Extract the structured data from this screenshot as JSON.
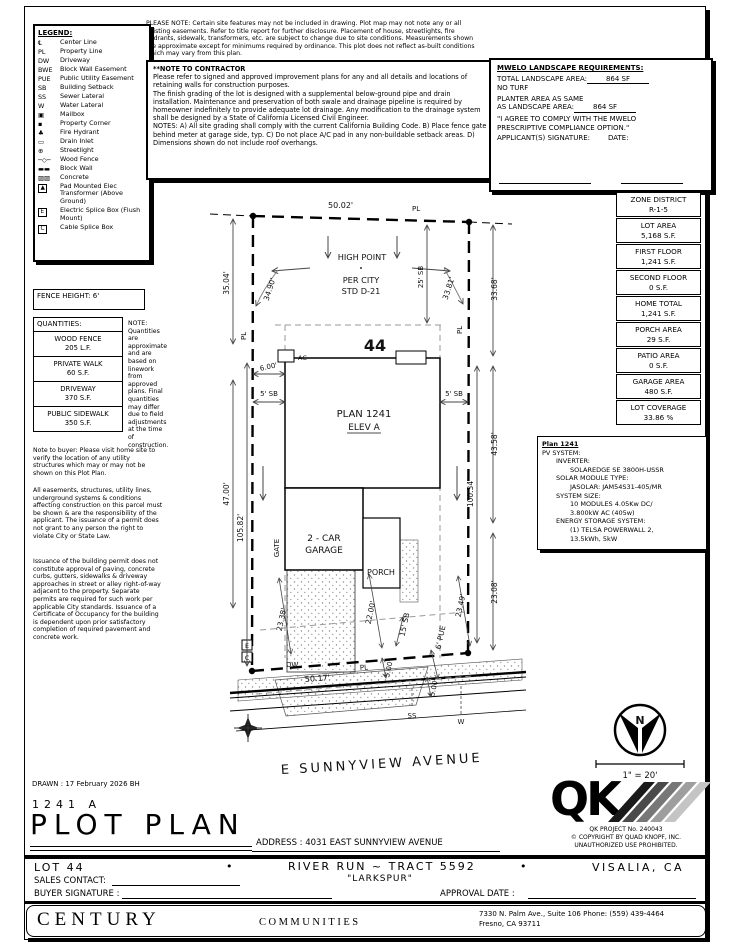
{
  "please_note": "PLEASE NOTE:  Certain site features may not be included in drawing.  Plot map may not note any or all existing easements.  Refer to title report for further disclosure.  Placement of house, streetlights, fire hydrants, sidewalk, transformers, etc. are subject to change due to site conditions.  Measurements shown are approximate except for minimums required by ordinance.  This plot does not reflect as-built conditions which may vary from this plan.",
  "legend": {
    "title": "LEGEND:",
    "items": [
      {
        "sym": "℄",
        "label": "Center Line"
      },
      {
        "sym": "PL",
        "label": "Property Line"
      },
      {
        "sym": "DW",
        "label": "Driveway"
      },
      {
        "sym": "BWE",
        "label": "Block Wall Easement"
      },
      {
        "sym": "PUE",
        "label": "Public Utility Easement"
      },
      {
        "sym": "SB",
        "label": "Building Setback"
      },
      {
        "sym": "SS",
        "label": "Sewer Lateral"
      },
      {
        "sym": "W",
        "label": "Water Lateral"
      },
      {
        "sym": "▣",
        "label": "Mailbox"
      },
      {
        "sym": "▪",
        "label": "Property Corner"
      },
      {
        "sym": "♣",
        "label": "Fire Hydrant"
      },
      {
        "sym": "▭",
        "label": "Drain Inlet"
      },
      {
        "sym": "⊕",
        "label": "Streetlight"
      },
      {
        "sym": "─◇─",
        "label": "Wood Fence"
      },
      {
        "sym": "▬▬",
        "label": "Block Wall"
      },
      {
        "sym": "▨▨",
        "label": "Concrete"
      },
      {
        "sym": "▲",
        "label": "Pad Mounted Elec Transformer (Above Ground)"
      },
      {
        "sym": "E",
        "label": "Electric Splice Box (Flush Mount)"
      },
      {
        "sym": "C",
        "label": "Cable Splice Box"
      }
    ]
  },
  "contractor_note": {
    "title": "**NOTE TO CONTRACTOR",
    "p1": "Please refer to signed and approved improvement plans for any and all details and locations of retaining walls for construction purposes.",
    "p2": "The finish grading of the lot is designed with a supplemental below-ground pipe and drain installation.  Maintenance and preservation of both swale and drainage pipeline is required by homeowner indefinitely to provide adequate lot drainage.  Any modification to the drainage system shall be designed by a State of California Licensed Civil Engineer.",
    "p3": "NOTES:  A) All site grading shall comply with the current California Building Code.  B) Place fence gate behind meter at garage side, typ.  C) Do not place A/C pad in any non-buildable setback areas.  D) Dimensions shown do not include roof overhangs."
  },
  "mwelo": {
    "title": "MWELO LANDSCAPE REQUIREMENTS:",
    "row1_label": "TOTAL LANDSCAPE AREA:",
    "row1_value": "864 SF",
    "row2": "NO TURF",
    "row3a": "PLANTER AREA AS SAME",
    "row3b": "AS LANDSCAPE AREA:",
    "row3_value": "864 SF",
    "agree": "\"I AGREE TO COMPLY WITH THE MWELO PRESCRIPTIVE COMPLIANCE OPTION.\"",
    "sig_label": "APPLICANT(S) SIGNATURE:",
    "date_label": "DATE:"
  },
  "fence_height": "FENCE HEIGHT: 6'",
  "quantities": {
    "title": "QUANTITIES:",
    "rows": [
      {
        "name": "WOOD FENCE",
        "value": "205 L.F."
      },
      {
        "name": "PRIVATE WALK",
        "value": "60 S.F."
      },
      {
        "name": "DRIVEWAY",
        "value": "370 S.F."
      },
      {
        "name": "PUBLIC SIDEWALK",
        "value": "350 S.F."
      }
    ],
    "note": "NOTE: Quantities are approximate and are based on linework from approved plans.  Final quantities may differ due to field adjustments at the time of construction."
  },
  "notes": {
    "buyer": "Note to buyer: Please visit home site to verify the location of any utility structures which may or may not be shown on this Plot Plan.",
    "easements": "All easements, structures, utility lines, underground systems & conditions affecting construction on this parcel must be shown & are the responsibility of the applicant.  The issuance of a permit does not grant to any person the right to violate City or State Law.",
    "permit": "Issuance of the building permit does not constitute approval of paving, concrete curbs, gutters, sidewalks & driveway approaches in street or alley right-of-way adjacent to the property.  Separate permits are required for such work per applicable City standards.  Issuance of a Certificate of Occupancy for the building is dependent upon prior satisfactory completion of required pavement and concrete work."
  },
  "zone_table": [
    {
      "label": "ZONE DISTRICT",
      "value": "R-1-5"
    },
    {
      "label": "LOT AREA",
      "value": "5,168 S.F."
    },
    {
      "label": "FIRST FLOOR",
      "value": "1,241 S.F."
    },
    {
      "label": "SECOND FLOOR",
      "value": "0 S.F."
    },
    {
      "label": "HOME TOTAL",
      "value": "1,241 S.F."
    },
    {
      "label": "PORCH AREA",
      "value": "29 S.F."
    },
    {
      "label": "PATIO AREA",
      "value": "0 S.F."
    },
    {
      "label": "GARAGE AREA",
      "value": "480 S.F."
    },
    {
      "label": "LOT COVERAGE",
      "value": "33.86 %"
    }
  ],
  "pv": {
    "title": "Plan 1241",
    "l1": "PV SYSTEM:",
    "l2": "INVERTER:",
    "l3": "SOLAREDGE SE 3800H-USSR",
    "l4": "SOLAR MODULE TYPE:",
    "l5": "JASOLAR: JAM54S31-405/MR",
    "l6": "SYSTEM SIZE:",
    "l7": "10 MODULES 4.05Kw DC/",
    "l8": "3.800kW AC (405w)",
    "l9": "ENERGY STORAGE SYSTEM:",
    "l10": "(1) TELSA POWERWALL 2,",
    "l11": "13.5kWh, 5kW"
  },
  "site": {
    "d50_02": "50.02'",
    "pl": "PL",
    "high1": "HIGH POINT",
    "high2": "PER CITY",
    "high3": "STD D-21",
    "sb25": "25' SB",
    "lot_no": "44",
    "ac": "AC",
    "d35_04": "35.04'",
    "d34_90": "34.90'",
    "d33_81": "33.81'",
    "d33_68": "33.68'",
    "d6_00": "6.00'",
    "sb5": "5' SB",
    "plan1": "PLAN 1241",
    "plan2": "ELEV A",
    "d47_00": "47.00'",
    "d105_82": "105.82'",
    "d100_34": "100.34'",
    "d43_58": "43.58'",
    "garage1": "2 - CAR",
    "garage2": "GARAGE",
    "porch": "PORCH",
    "gate": "GATE",
    "d23_38": "23.38'",
    "d22_00": "22.00'",
    "sb15": "15' SB",
    "pue6": "6' PUE",
    "d23_49": "23.49'",
    "d23_08": "23.08'",
    "d5_00": "5.00'",
    "dw": "DW",
    "d50_17": "50.17'",
    "ss": "SS",
    "w": "W",
    "e": "E",
    "c": "C",
    "street": "E SUNNYVIEW AVENUE"
  },
  "compass": {
    "north": "N",
    "scale": "1\" = 20'"
  },
  "qk": {
    "letters": "QK",
    "project": "QK PROJECT No. 240043",
    "copyright": "©  COPYRIGHT BY QUAD KNOPF, INC.",
    "unauthorized": "UNAUTHORIZED USE PROHIBITED."
  },
  "titleblock": {
    "drawn": "DRAWN :  17 February 2026   BH",
    "plan_no": "1241    A",
    "title": "PLOT PLAN",
    "address_label": "ADDRESS :   4031 EAST SUNNYVIEW AVENUE",
    "lot": "LOT  44",
    "bullet": "•",
    "tract": "RIVER RUN ~ TRACT 5592",
    "community": "\"LARKSPUR\"",
    "city": "VISALIA, CA",
    "sales_contact": "SALES CONTACT:",
    "buyer_signature": "BUYER SIGNATURE :",
    "approval_date": "APPROVAL DATE :",
    "century": "CENTURY",
    "communities": "COMMUNITIES",
    "office_line1": "7330 N. Palm Ave., Suite 106     Phone:  (559) 439-4464",
    "office_line2": "Fresno, CA  93711"
  }
}
